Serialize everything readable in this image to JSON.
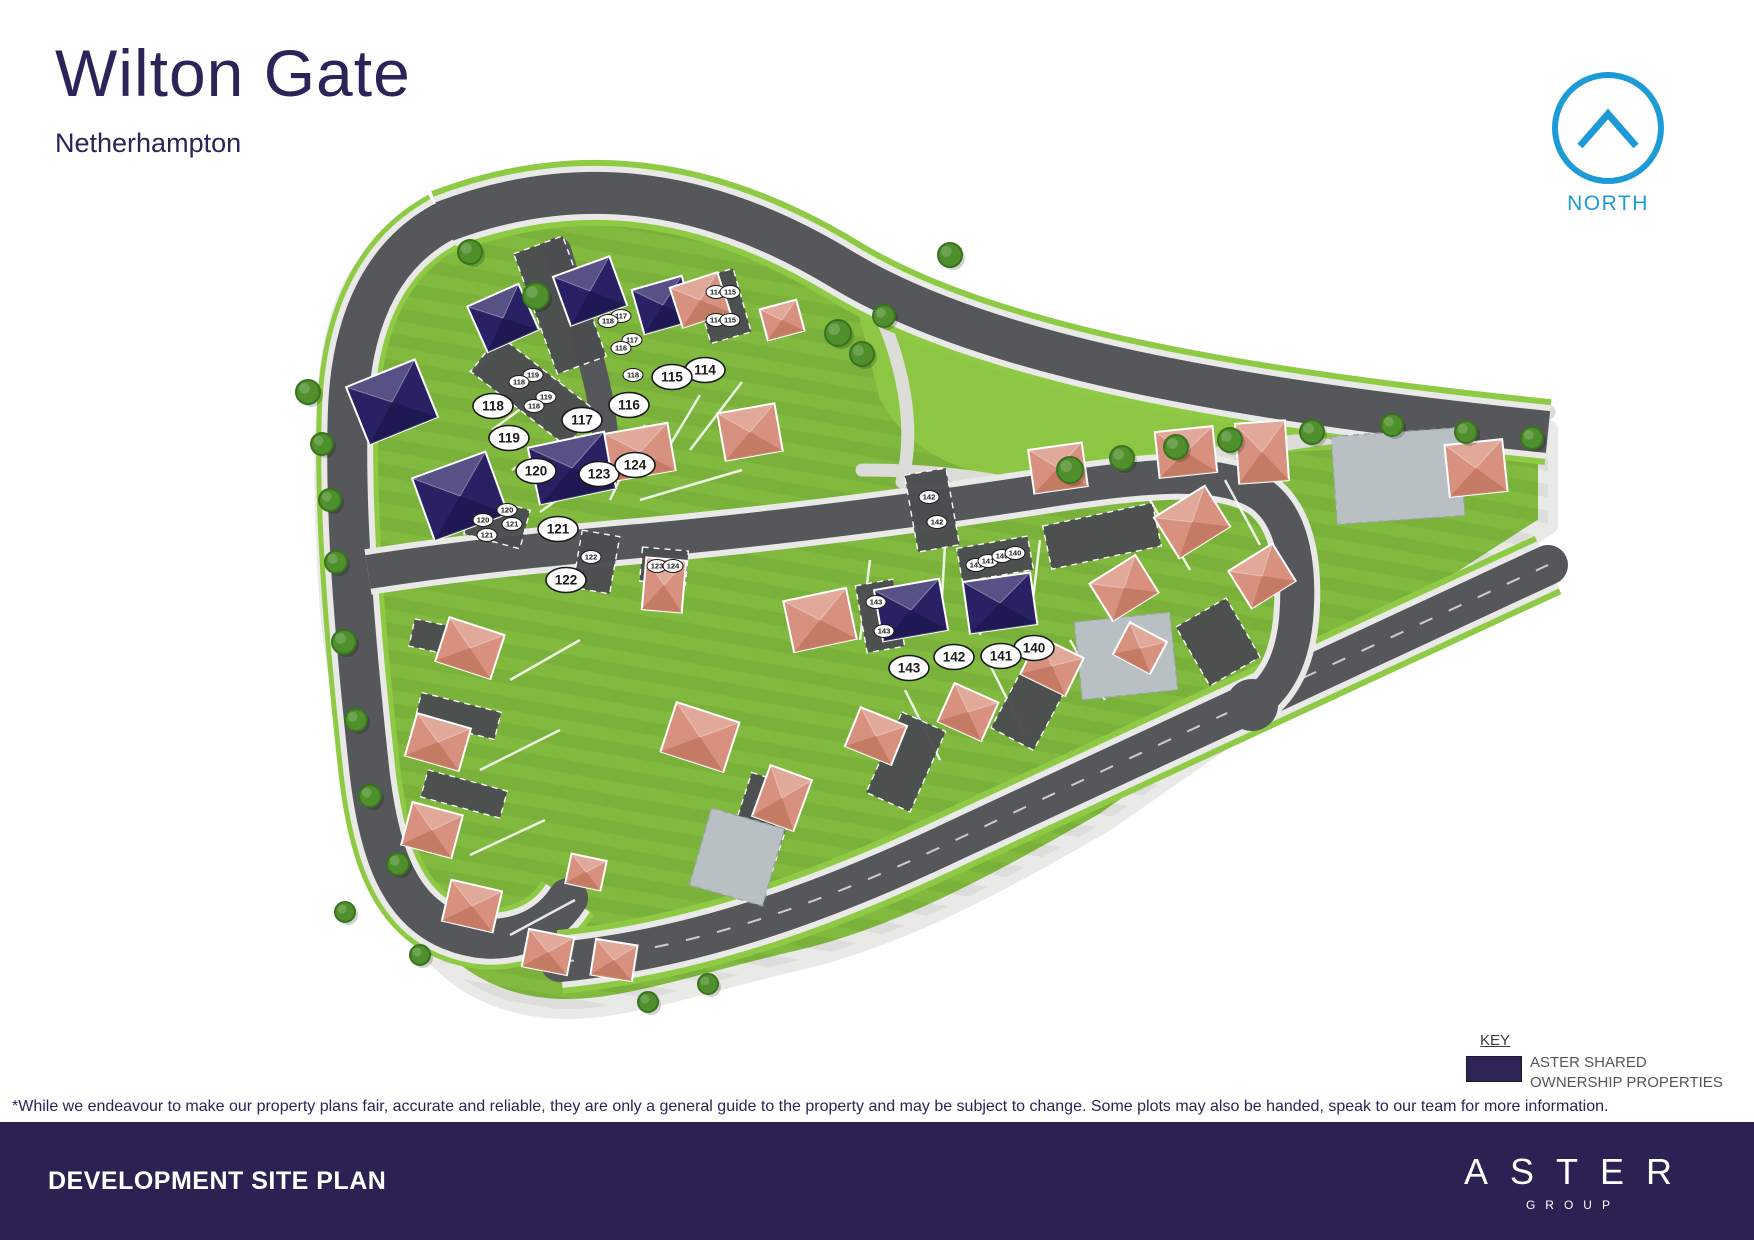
{
  "header": {
    "title": "Wilton Gate",
    "subtitle": "Netherhampton"
  },
  "north": {
    "label": "NORTH",
    "color": "#1d9bd7"
  },
  "key": {
    "heading": "KEY",
    "swatch_color": "#2e2457",
    "label_line1": "ASTER SHARED",
    "label_line2": "OWNERSHIP PROPERTIES"
  },
  "disclaimer": "*While we endeavour to make our property plans fair, accurate and reliable, they are only a general guide to the property and may be subject to change. Some plots may also be handed, speak to our team for more information.",
  "footer": {
    "title": "DEVELOPMENT SITE PLAN",
    "brand_name": "ASTER",
    "brand_sub": "GROUP",
    "bg": "#2b2153"
  },
  "map": {
    "colors": {
      "grass": "#81ba3e",
      "verge": "#8fca44",
      "road": "#55575a",
      "sidewalk": "#e9e9e7",
      "park_path": "#dcdcd8",
      "court_dark": "#4b4d50",
      "court_gray": "#b9c0c4",
      "house_private": "#d8917e",
      "house_private_dark": "#c2765f",
      "house_shared": "#2a2164",
      "house_shared_dark": "#1d1850",
      "tree": "#4f8f2c",
      "tree_edge": "#3a731f",
      "label_bg": "#ffffff",
      "label_text": "#1a1a1a"
    },
    "legend_meaning": {
      "shared": "ASTER SHARED OWNERSHIP PROPERTIES",
      "private": "private plot"
    },
    "plots": [
      {
        "num": "114",
        "x": 705,
        "y": 370
      },
      {
        "num": "115",
        "x": 672,
        "y": 377
      },
      {
        "num": "116",
        "x": 629,
        "y": 405
      },
      {
        "num": "117",
        "x": 582,
        "y": 420
      },
      {
        "num": "118",
        "x": 493,
        "y": 406
      },
      {
        "num": "119",
        "x": 509,
        "y": 438
      },
      {
        "num": "120",
        "x": 536,
        "y": 471
      },
      {
        "num": "121",
        "x": 558,
        "y": 529
      },
      {
        "num": "122",
        "x": 566,
        "y": 580
      },
      {
        "num": "123",
        "x": 599,
        "y": 474
      },
      {
        "num": "124",
        "x": 635,
        "y": 465
      },
      {
        "num": "140",
        "x": 1034,
        "y": 648
      },
      {
        "num": "141",
        "x": 1001,
        "y": 656
      },
      {
        "num": "142",
        "x": 954,
        "y": 657
      },
      {
        "num": "143",
        "x": 909,
        "y": 668
      }
    ],
    "parking_labels": [
      {
        "num": "117",
        "x": 621,
        "y": 316
      },
      {
        "num": "118",
        "x": 608,
        "y": 321
      },
      {
        "num": "117",
        "x": 632,
        "y": 340
      },
      {
        "num": "116",
        "x": 621,
        "y": 348
      },
      {
        "num": "118",
        "x": 633,
        "y": 375
      },
      {
        "num": "114",
        "x": 716,
        "y": 292
      },
      {
        "num": "115",
        "x": 730,
        "y": 292
      },
      {
        "num": "114",
        "x": 716,
        "y": 320
      },
      {
        "num": "115",
        "x": 730,
        "y": 320
      },
      {
        "num": "119",
        "x": 533,
        "y": 375
      },
      {
        "num": "118",
        "x": 519,
        "y": 382
      },
      {
        "num": "119",
        "x": 546,
        "y": 397
      },
      {
        "num": "118",
        "x": 534,
        "y": 406
      },
      {
        "num": "120",
        "x": 507,
        "y": 510
      },
      {
        "num": "121",
        "x": 512,
        "y": 524
      },
      {
        "num": "120",
        "x": 483,
        "y": 520
      },
      {
        "num": "121",
        "x": 487,
        "y": 535
      },
      {
        "num": "122",
        "x": 591,
        "y": 557
      },
      {
        "num": "123",
        "x": 657,
        "y": 566
      },
      {
        "num": "124",
        "x": 673,
        "y": 566
      },
      {
        "num": "142",
        "x": 929,
        "y": 497
      },
      {
        "num": "142",
        "x": 937,
        "y": 522
      },
      {
        "num": "143",
        "x": 876,
        "y": 602
      },
      {
        "num": "143",
        "x": 884,
        "y": 631
      },
      {
        "num": "141",
        "x": 976,
        "y": 565
      },
      {
        "num": "141",
        "x": 988,
        "y": 561
      },
      {
        "num": "140",
        "x": 1002,
        "y": 556
      },
      {
        "num": "140",
        "x": 1015,
        "y": 553
      }
    ],
    "house_format": "[cx, cy, width, height, rotation_deg, type a=aster-shared p=private]",
    "houses": [
      [
        392,
        402,
        74,
        62,
        -22,
        "a"
      ],
      [
        460,
        496,
        78,
        66,
        -20,
        "a"
      ],
      [
        572,
        468,
        78,
        58,
        -12,
        "a"
      ],
      [
        503,
        318,
        56,
        50,
        -24,
        "a"
      ],
      [
        590,
        291,
        60,
        52,
        -20,
        "a"
      ],
      [
        663,
        305,
        52,
        46,
        -16,
        "a"
      ],
      [
        911,
        610,
        66,
        52,
        -10,
        "a"
      ],
      [
        1000,
        603,
        68,
        52,
        -8,
        "a"
      ],
      [
        700,
        300,
        50,
        42,
        -18,
        "p"
      ],
      [
        782,
        320,
        38,
        32,
        -15,
        "p"
      ],
      [
        640,
        452,
        64,
        48,
        -10,
        "p"
      ],
      [
        750,
        432,
        58,
        48,
        -10,
        "p"
      ],
      [
        820,
        620,
        64,
        52,
        -12,
        "p"
      ],
      [
        664,
        585,
        40,
        52,
        5,
        "p"
      ],
      [
        1192,
        522,
        60,
        48,
        -32,
        "p"
      ],
      [
        1262,
        576,
        52,
        44,
        -32,
        "p"
      ],
      [
        1124,
        588,
        54,
        44,
        -32,
        "p"
      ],
      [
        1186,
        452,
        58,
        46,
        -6,
        "p"
      ],
      [
        1262,
        452,
        50,
        60,
        -4,
        "p"
      ],
      [
        1058,
        468,
        54,
        44,
        -8,
        "p"
      ],
      [
        1476,
        468,
        58,
        52,
        -6,
        "p"
      ],
      [
        470,
        648,
        58,
        46,
        18,
        "p"
      ],
      [
        438,
        742,
        56,
        44,
        16,
        "p"
      ],
      [
        432,
        830,
        52,
        44,
        15,
        "p"
      ],
      [
        472,
        906,
        52,
        42,
        13,
        "p"
      ],
      [
        548,
        952,
        46,
        38,
        11,
        "p"
      ],
      [
        614,
        960,
        42,
        36,
        9,
        "p"
      ],
      [
        586,
        872,
        36,
        30,
        12,
        "p"
      ],
      [
        700,
        737,
        66,
        52,
        18,
        "p"
      ],
      [
        782,
        798,
        44,
        54,
        20,
        "p"
      ],
      [
        876,
        736,
        50,
        42,
        22,
        "p"
      ],
      [
        968,
        712,
        48,
        42,
        24,
        "p"
      ],
      [
        1052,
        666,
        50,
        42,
        26,
        "p"
      ],
      [
        1140,
        648,
        42,
        36,
        28,
        "p"
      ]
    ],
    "court_format": "[cx, cy, width, height, rotation_deg]",
    "courts_dark": [
      [
        560,
        305,
        52,
        128,
        -20
      ],
      [
        722,
        306,
        42,
        66,
        -16
      ],
      [
        533,
        391,
        122,
        46,
        38
      ],
      [
        497,
        522,
        58,
        40,
        15
      ],
      [
        596,
        562,
        38,
        58,
        10
      ],
      [
        664,
        566,
        46,
        34,
        5
      ],
      [
        932,
        510,
        42,
        78,
        -10
      ],
      [
        880,
        616,
        38,
        68,
        -10
      ],
      [
        995,
        559,
        72,
        34,
        -10
      ],
      [
        1102,
        536,
        112,
        44,
        -12
      ],
      [
        762,
        822,
        50,
        88,
        18
      ],
      [
        906,
        762,
        48,
        88,
        24
      ],
      [
        1032,
        702,
        48,
        84,
        28
      ],
      [
        1218,
        642,
        58,
        68,
        -30
      ],
      [
        452,
        641,
        82,
        28,
        12
      ],
      [
        458,
        716,
        82,
        28,
        14
      ],
      [
        464,
        794,
        82,
        28,
        15
      ]
    ],
    "courts_gray": [
      [
        1398,
        476,
        128,
        88,
        -4
      ],
      [
        1126,
        656,
        96,
        78,
        -6
      ],
      [
        737,
        857,
        76,
        80,
        16
      ]
    ],
    "trees": [
      [
        536,
        296,
        13
      ],
      [
        470,
        252,
        12
      ],
      [
        308,
        392,
        12
      ],
      [
        322,
        444,
        11
      ],
      [
        330,
        500,
        11
      ],
      [
        336,
        562,
        11
      ],
      [
        344,
        642,
        12
      ],
      [
        356,
        720,
        11
      ],
      [
        370,
        796,
        11
      ],
      [
        398,
        864,
        11
      ],
      [
        345,
        912,
        10
      ],
      [
        420,
        955,
        10
      ],
      [
        648,
        1002,
        10
      ],
      [
        708,
        984,
        10
      ],
      [
        838,
        333,
        13
      ],
      [
        862,
        354,
        12
      ],
      [
        884,
        316,
        11
      ],
      [
        950,
        255,
        12
      ],
      [
        1070,
        470,
        13
      ],
      [
        1122,
        458,
        12
      ],
      [
        1176,
        447,
        12
      ],
      [
        1230,
        440,
        12
      ],
      [
        1312,
        432,
        12
      ],
      [
        1392,
        425,
        11
      ],
      [
        1466,
        432,
        11
      ],
      [
        1532,
        438,
        11
      ]
    ]
  }
}
